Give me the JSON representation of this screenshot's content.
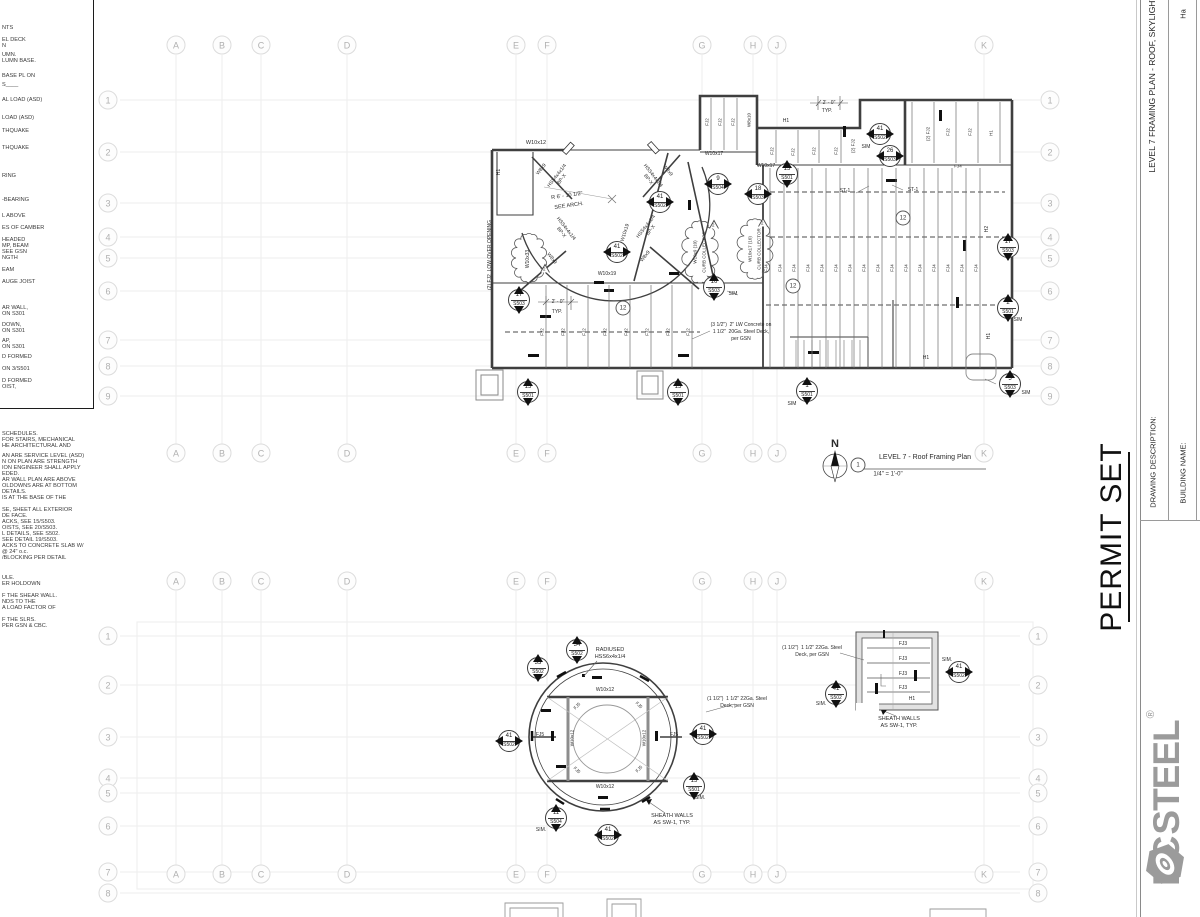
{
  "title_block": {
    "permit_set": "PERMIT SET",
    "drawing_description_label": "DRAWING DESCRIPTION:",
    "building_name_label": "BUILDING NAME:",
    "sheet_title_vertical": "LEVEL 7 FRAMING PLAN - ROOF, SKYLIGHT",
    "partial_text": "Ha",
    "logo": {
      "prefix": "EC",
      "suffix": "STEEL",
      "registered": "®",
      "nut_icon": "hex-nut-icon",
      "color": "#9b9b9b"
    }
  },
  "plan_title": {
    "bubble": "1",
    "name": "LEVEL 7 - Roof Framing Plan",
    "scale": "1/4\" = 1'-0\"",
    "north": "N"
  },
  "grid": {
    "letters": [
      "A",
      "B",
      "C",
      "D",
      "E",
      "F",
      "G",
      "H",
      "J",
      "K"
    ],
    "letter_x": [
      176,
      222,
      261,
      347,
      516,
      547,
      702,
      753,
      777,
      984
    ],
    "letter_rows_y": [
      45,
      453,
      581,
      874
    ],
    "upper_rows": [
      "1",
      "2",
      "3",
      "4",
      "5",
      "6",
      "7",
      "8",
      "9"
    ],
    "upper_rows_y": [
      100,
      152,
      203,
      237,
      258,
      291,
      340,
      366,
      396
    ],
    "upper_left_x": 108,
    "upper_right_x": 1050,
    "lower_rows": [
      "1",
      "2",
      "3",
      "4",
      "5",
      "6",
      "7",
      "8"
    ],
    "lower_rows_y": [
      636,
      685,
      737,
      778,
      793,
      826,
      872,
      893
    ],
    "lower_left_x": 108,
    "lower_right_x": 1038
  },
  "left_notes": {
    "box_lines": [
      {
        "t": "NTS",
        "y": 28
      },
      {
        "t": "EL DECK",
        "y": 40
      },
      {
        "t": "N",
        "y": 46
      },
      {
        "t": "UMN.",
        "y": 55
      },
      {
        "t": "LUMN BASE.",
        "y": 61
      },
      {
        "t": "BASE PL ON",
        "y": 76
      },
      {
        "t": "S____",
        "y": 85
      },
      {
        "t": "AL LOAD (ASD)",
        "y": 100
      },
      {
        "t": "LOAD (ASD)",
        "y": 118
      },
      {
        "t": "THQUAKE",
        "y": 131
      },
      {
        "t": "THQUAKE",
        "y": 148
      },
      {
        "t": "RING",
        "y": 176
      },
      {
        "t": "-BEARING",
        "y": 200
      },
      {
        "t": "L ABOVE",
        "y": 216
      },
      {
        "t": "ES OF CAMBER",
        "y": 228
      },
      {
        "t": "HEADED",
        "y": 240
      },
      {
        "t": "MP, BEAM",
        "y": 246
      },
      {
        "t": "SEE GSN",
        "y": 252
      },
      {
        "t": "NGTH",
        "y": 258
      },
      {
        "t": "EAM",
        "y": 270
      },
      {
        "t": "AUGE JOIST",
        "y": 282
      },
      {
        "t": "AR WALL,",
        "y": 308
      },
      {
        "t": "ON S301",
        "y": 314
      },
      {
        "t": "DOWN,",
        "y": 325
      },
      {
        "t": "ON S301",
        "y": 331
      },
      {
        "t": "AP,",
        "y": 341
      },
      {
        "t": "ON S301",
        "y": 347
      },
      {
        "t": "D FORMED",
        "y": 357
      },
      {
        "t": "ON 3/S501",
        "y": 369
      },
      {
        "t": "D FORMED",
        "y": 381
      },
      {
        "t": "OIST,",
        "y": 387
      }
    ],
    "lower_lines": [
      {
        "t": "SCHEDULES.",
        "y": 434
      },
      {
        "t": "FOR STAIRS, MECHANICAL",
        "y": 440
      },
      {
        "t": "HE ARCHITECTURAL AND",
        "y": 446
      },
      {
        "t": "AN ARE SERVICE LEVEL (ASD)",
        "y": 456
      },
      {
        "t": "N ON PLAN ARE STRENGTH",
        "y": 462
      },
      {
        "t": "ION ENGINEER SHALL APPLY",
        "y": 468
      },
      {
        "t": "EDED.",
        "y": 474
      },
      {
        "t": "AR WALL PLAN ARE ABOVE",
        "y": 480
      },
      {
        "t": "OLDOWNS ARE AT BOTTOM",
        "y": 486
      },
      {
        "t": "DETAILS.",
        "y": 492
      },
      {
        "t": "IS AT THE BASE OF THE",
        "y": 498
      },
      {
        "t": "SE, SHEET ALL EXTERIOR",
        "y": 510
      },
      {
        "t": "DE FACE.",
        "y": 516
      },
      {
        "t": "ACKS, SEE 15/S503.",
        "y": 522
      },
      {
        "t": "OISTS, SEE 20/S503.",
        "y": 528
      },
      {
        "t": "L DETAILS, SEE S502.",
        "y": 534
      },
      {
        "t": "SEE DETAIL 19/S503.",
        "y": 540
      },
      {
        "t": "ACKS TO CONCRETE SLAB W/",
        "y": 546
      },
      {
        "t": "@ 24\" o.c.",
        "y": 552
      },
      {
        "t": "/BLOCKING PER DETAIL",
        "y": 558
      },
      {
        "t": "ULE.",
        "y": 578
      },
      {
        "t": "ER HOLDOWN",
        "y": 584
      },
      {
        "t": "F THE SHEAR WALL.",
        "y": 596
      },
      {
        "t": "NDS TO THE",
        "y": 602
      },
      {
        "t": "A LOAD FACTOR OF",
        "y": 608
      },
      {
        "t": "F THE SLRS.",
        "y": 620
      },
      {
        "t": "PER GSN & CBC.",
        "y": 626
      }
    ]
  },
  "upper_plan": {
    "labels": [
      {
        "t": "W10x12",
        "x": 536,
        "y": 143
      },
      {
        "t": "H1",
        "x": 500,
        "y": 172,
        "r": -90,
        "fs": 5
      },
      {
        "t": "(2) FJ2  LOW OVER OPENING",
        "x": 491,
        "y": 255,
        "r": -90,
        "fs": 5
      },
      {
        "t": "HSS4x4x1/4\nBP-X",
        "x": 560,
        "y": 178,
        "r": -52,
        "fs": 5
      },
      {
        "t": "HSS4x4x1/4\nBP-X",
        "x": 650,
        "y": 178,
        "r": 52,
        "fs": 5
      },
      {
        "t": "HSS4x4x1/4\nBP-X",
        "x": 563,
        "y": 231,
        "r": 52,
        "fs": 5
      },
      {
        "t": "HSS4x4x1/4\nBP-X",
        "x": 649,
        "y": 229,
        "r": -52,
        "fs": 5
      },
      {
        "t": "W8x9",
        "x": 542,
        "y": 170,
        "r": -52,
        "fs": 5
      },
      {
        "t": "W8x9",
        "x": 667,
        "y": 171,
        "r": 52,
        "fs": 5
      },
      {
        "t": "W8x9",
        "x": 551,
        "y": 259,
        "r": 52,
        "fs": 5
      },
      {
        "t": "W8x9",
        "x": 646,
        "y": 257,
        "r": -52,
        "fs": 5
      },
      {
        "t": "R 6' - 10 1/2\"",
        "x": 567,
        "y": 196,
        "r": -8,
        "fs": 5.5
      },
      {
        "t": "SEE ARCH.",
        "x": 569,
        "y": 206,
        "r": -8,
        "fs": 5.5
      },
      {
        "t": "W10x33",
        "x": 529,
        "y": 259,
        "r": -90,
        "fs": 5
      },
      {
        "t": "W10x9 (10)",
        "x": 695,
        "y": 252,
        "r": -90,
        "fs": 4.5
      },
      {
        "t": "CURB COLLECTOR",
        "x": 704,
        "y": 252,
        "r": -90,
        "fs": 4.5
      },
      {
        "t": "W10x17 (10)",
        "x": 750,
        "y": 249,
        "r": -90,
        "fs": 4.5
      },
      {
        "t": "CURB COLLECTOR",
        "x": 759,
        "y": 249,
        "r": -90,
        "fs": 4.5
      },
      {
        "t": "W10x19",
        "x": 626,
        "y": 233,
        "r": -72,
        "fs": 5
      },
      {
        "t": "W10x19",
        "x": 607,
        "y": 275,
        "fs": 5
      },
      {
        "t": "W10x17",
        "x": 714,
        "y": 155,
        "fs": 5
      },
      {
        "t": "W10x17",
        "x": 766,
        "y": 167,
        "fs": 5
      },
      {
        "t": "H1",
        "x": 786,
        "y": 122,
        "fs": 5
      },
      {
        "t": "2' - 0\"",
        "x": 829,
        "y": 104,
        "fs": 5
      },
      {
        "t": "TYP.",
        "x": 827,
        "y": 112,
        "fs": 5
      },
      {
        "t": "(2) FJ2",
        "x": 853,
        "y": 146,
        "r": -90,
        "fs": 4.5
      },
      {
        "t": "SIM",
        "x": 866,
        "y": 148,
        "fs": 5
      },
      {
        "t": "FJ2",
        "x": 707,
        "y": 122,
        "r": -90,
        "fs": 4.5
      },
      {
        "t": "FJ2",
        "x": 720,
        "y": 122,
        "r": -90,
        "fs": 4.5
      },
      {
        "t": "FJ2",
        "x": 733,
        "y": 122,
        "r": -90,
        "fs": 4.5
      },
      {
        "t": "W8x10",
        "x": 749,
        "y": 120,
        "r": -90,
        "fs": 4.5
      },
      {
        "t": "FJ2",
        "x": 772,
        "y": 151,
        "r": -90,
        "fs": 4.5
      },
      {
        "t": "FJ2",
        "x": 793,
        "y": 152,
        "r": -90,
        "fs": 4.5
      },
      {
        "t": "FJ2",
        "x": 814,
        "y": 151,
        "r": -90,
        "fs": 4.5
      },
      {
        "t": "FJ2",
        "x": 836,
        "y": 151,
        "r": -90,
        "fs": 4.5
      },
      {
        "t": "(2) FJ2",
        "x": 928,
        "y": 134,
        "r": -90,
        "fs": 4.5
      },
      {
        "t": "FJ2",
        "x": 948,
        "y": 132,
        "r": -90,
        "fs": 4.5
      },
      {
        "t": "FJ2",
        "x": 970,
        "y": 132,
        "r": -90,
        "fs": 4.5
      },
      {
        "t": "H1",
        "x": 991,
        "y": 133,
        "r": -90,
        "fs": 4.5
      },
      {
        "t": "FJ4",
        "x": 958,
        "y": 166,
        "fs": 4.5
      },
      {
        "t": "ST-1",
        "x": 845,
        "y": 192,
        "fs": 5
      },
      {
        "t": "ST-1",
        "x": 913,
        "y": 191,
        "fs": 5
      },
      {
        "t": "H2",
        "x": 988,
        "y": 229,
        "r": -90,
        "fs": 5
      },
      {
        "t": "H1",
        "x": 990,
        "y": 336,
        "r": -90,
        "fs": 5
      },
      {
        "t": "H1",
        "x": 926,
        "y": 359,
        "fs": 5
      },
      {
        "t": "2' - 0\"",
        "x": 558,
        "y": 303,
        "fs": 5
      },
      {
        "t": "TYP.",
        "x": 557,
        "y": 313,
        "fs": 5
      },
      {
        "t": "(3 1/2\")  2\" LW Concrete on",
        "x": 741,
        "y": 326,
        "fs": 5
      },
      {
        "t": "1 1/2\"  20Ga. Steel Deck,",
        "x": 741,
        "y": 333,
        "fs": 5
      },
      {
        "t": "per GSN",
        "x": 741,
        "y": 340,
        "fs": 5
      },
      {
        "t": "SIM",
        "x": 733,
        "y": 295,
        "fs": 5
      },
      {
        "t": "SIM",
        "x": 1018,
        "y": 321,
        "fs": 5
      },
      {
        "t": "SIM",
        "x": 792,
        "y": 405,
        "fs": 5
      },
      {
        "t": "SIM",
        "x": 1026,
        "y": 394,
        "fs": 5
      }
    ],
    "joist_groups": [
      {
        "label": "FJ2",
        "xs": [
          546,
          567,
          588,
          609,
          630,
          651,
          672,
          692
        ],
        "y1": 285,
        "y2": 368,
        "label_y": 332,
        "dx": -4
      },
      {
        "label": "FJ4",
        "xs": [
          770,
          784,
          798,
          812,
          826,
          840,
          854,
          868,
          882,
          896,
          910,
          924,
          938,
          952,
          966,
          980
        ],
        "y1": 168,
        "y2": 368,
        "label_y": 268,
        "dx": -4
      },
      {
        "label": "FJ2",
        "xs": [
          711,
          724,
          737
        ],
        "y1": 98,
        "y2": 150,
        "label_y": null,
        "dx": -4
      },
      {
        "label": "FJ2",
        "xs": [
          776,
          798,
          819,
          841
        ],
        "y1": 130,
        "y2": 163,
        "label_y": null,
        "dx": -4
      },
      {
        "label": "FJ2",
        "xs": [
          912,
          934,
          956,
          978,
          1000
        ],
        "y1": 102,
        "y2": 163,
        "label_y": null,
        "dx": -4
      },
      {
        "label": "",
        "xs": [
          796,
          804,
          812,
          820,
          828,
          836,
          844,
          852,
          860
        ],
        "y1": 340,
        "y2": 367,
        "label_y": null,
        "dx": 0
      }
    ],
    "bubbles": [
      {
        "n": "41",
        "s": "S502",
        "x": 660,
        "y": 202,
        "t": [
          "l",
          "r"
        ]
      },
      {
        "n": "41",
        "s": "S502",
        "x": 617,
        "y": 252,
        "t": [
          "l",
          "r"
        ]
      },
      {
        "n": "41",
        "s": "S502",
        "x": 880,
        "y": 134,
        "t": [
          "l",
          "r"
        ]
      },
      {
        "n": "26",
        "s": "S503",
        "x": 890,
        "y": 156,
        "t": [
          "l",
          "r"
        ]
      },
      {
        "n": "9",
        "s": "S504",
        "x": 718,
        "y": 184,
        "t": [
          "l",
          "r"
        ]
      },
      {
        "n": "18",
        "s": "S503",
        "x": 758,
        "y": 194,
        "t": [
          "l",
          "r"
        ]
      },
      {
        "n": "15",
        "s": "S501",
        "x": 787,
        "y": 174,
        "t": [
          "u",
          "d"
        ]
      },
      {
        "n": "17",
        "s": "S503",
        "x": 519,
        "y": 300,
        "t": [
          "u",
          "d"
        ]
      },
      {
        "n": "16",
        "s": "S503",
        "x": 714,
        "y": 287,
        "t": [
          "u",
          "d"
        ]
      },
      {
        "n": "17",
        "s": "S503",
        "x": 1008,
        "y": 247,
        "t": [
          "u",
          "d"
        ]
      },
      {
        "n": "2",
        "s": "S501",
        "x": 1008,
        "y": 308,
        "t": [
          "u",
          "d"
        ]
      },
      {
        "n": "1",
        "s": "S501",
        "x": 807,
        "y": 391,
        "t": [
          "u",
          "d"
        ]
      },
      {
        "n": "5",
        "s": "S503",
        "x": 1010,
        "y": 384,
        "t": [
          "u",
          "d"
        ]
      },
      {
        "n": "15",
        "s": "S501",
        "x": 528,
        "y": 392,
        "t": [
          "u",
          "d"
        ]
      },
      {
        "n": "15",
        "s": "S501",
        "x": 678,
        "y": 392,
        "t": [
          "u",
          "d"
        ]
      }
    ],
    "circle_markers": [
      {
        "t": "12",
        "x": 623,
        "y": 308
      },
      {
        "t": "12",
        "x": 793,
        "y": 286
      },
      {
        "t": "12",
        "x": 903,
        "y": 218
      }
    ],
    "deltas": [
      {
        "t": "2",
        "x": 545,
        "y": 268
      },
      {
        "t": "2",
        "x": 714,
        "y": 224
      },
      {
        "t": "2",
        "x": 763,
        "y": 222
      }
    ],
    "clouds": [
      {
        "cx": 529,
        "cy": 258,
        "rx": 13,
        "ry": 24
      },
      {
        "cx": 700,
        "cy": 252,
        "rx": 12,
        "ry": 31
      },
      {
        "cx": 755,
        "cy": 249,
        "rx": 12,
        "ry": 30
      }
    ]
  },
  "lower_plan": {
    "labels": [
      {
        "t": "RADIUSED",
        "x": 610,
        "y": 650,
        "fs": 5.5
      },
      {
        "t": "HSS6x4x1/4",
        "x": 610,
        "y": 657,
        "fs": 5.5
      },
      {
        "t": "W10x12",
        "x": 605,
        "y": 691,
        "fs": 5
      },
      {
        "t": "W10x12",
        "x": 605,
        "y": 788,
        "fs": 5
      },
      {
        "t": "W10x12",
        "x": 572,
        "y": 738,
        "r": -90,
        "fs": 4.5
      },
      {
        "t": "W10x12",
        "x": 644,
        "y": 738,
        "r": -90,
        "fs": 4.5
      },
      {
        "t": "FJ5",
        "x": 540,
        "y": 736,
        "fs": 5
      },
      {
        "t": "FJ5",
        "x": 674,
        "y": 736,
        "fs": 5
      },
      {
        "t": "FJ5",
        "x": 577,
        "y": 706,
        "r": -45,
        "fs": 4.5
      },
      {
        "t": "FJ5",
        "x": 639,
        "y": 705,
        "r": 45,
        "fs": 4.5
      },
      {
        "t": "FJ5",
        "x": 577,
        "y": 770,
        "r": 45,
        "fs": 4.5
      },
      {
        "t": "FJ5",
        "x": 639,
        "y": 769,
        "r": -45,
        "fs": 4.5
      },
      {
        "t": "(1 1/2\")  1 1/2\" 22Ga. Steel",
        "x": 737,
        "y": 700,
        "fs": 5
      },
      {
        "t": "Deck, per GSN",
        "x": 737,
        "y": 707,
        "fs": 5
      },
      {
        "t": "SHEATH WALLS",
        "x": 672,
        "y": 816,
        "fs": 5.5
      },
      {
        "t": "AS SW-1, TYP.",
        "x": 672,
        "y": 823,
        "fs": 5.5
      },
      {
        "t": "SIM.",
        "x": 700,
        "y": 799,
        "fs": 5
      },
      {
        "t": "SIM.",
        "x": 541,
        "y": 831,
        "fs": 5
      },
      {
        "t": "(1 1/2\")  1 1/2\" 22Ga. Steel",
        "x": 812,
        "y": 649,
        "fs": 5
      },
      {
        "t": "Deck, per GSN",
        "x": 812,
        "y": 656,
        "fs": 5
      },
      {
        "t": "FJ3",
        "x": 903,
        "y": 645,
        "fs": 5
      },
      {
        "t": "FJ3",
        "x": 903,
        "y": 660,
        "fs": 5
      },
      {
        "t": "FJ3",
        "x": 903,
        "y": 675,
        "fs": 5
      },
      {
        "t": "FJ3",
        "x": 903,
        "y": 689,
        "fs": 5
      },
      {
        "t": "H1",
        "x": 912,
        "y": 700,
        "fs": 5
      },
      {
        "t": "SIM.",
        "x": 947,
        "y": 661,
        "fs": 5
      },
      {
        "t": "SIM.",
        "x": 821,
        "y": 705,
        "fs": 5
      },
      {
        "t": "SHEATH WALLS",
        "x": 899,
        "y": 719,
        "fs": 5.5
      },
      {
        "t": "AS SW-1, TYP.",
        "x": 899,
        "y": 726,
        "fs": 5.5
      }
    ],
    "bubbles": [
      {
        "n": "34",
        "s": "S502",
        "x": 577,
        "y": 650,
        "t": [
          "u",
          "d"
        ]
      },
      {
        "n": "33",
        "s": "S502",
        "x": 538,
        "y": 668,
        "t": [
          "u",
          "d"
        ]
      },
      {
        "n": "41",
        "s": "S502",
        "x": 509,
        "y": 741,
        "t": [
          "l",
          "r"
        ]
      },
      {
        "n": "41",
        "s": "S502",
        "x": 703,
        "y": 734,
        "t": [
          "l",
          "r"
        ]
      },
      {
        "n": "41",
        "s": "S502",
        "x": 608,
        "y": 835,
        "t": [
          "l",
          "r"
        ]
      },
      {
        "n": "15",
        "s": "S501",
        "x": 694,
        "y": 786,
        "t": [
          "u",
          "d"
        ]
      },
      {
        "n": "11",
        "s": "S504",
        "x": 556,
        "y": 818,
        "t": [
          "u",
          "d"
        ]
      },
      {
        "n": "41",
        "s": "S502",
        "x": 836,
        "y": 694,
        "t": [
          "u",
          "d"
        ]
      },
      {
        "n": "41",
        "s": "S502",
        "x": 959,
        "y": 672,
        "t": [
          "l",
          "r"
        ]
      }
    ]
  }
}
